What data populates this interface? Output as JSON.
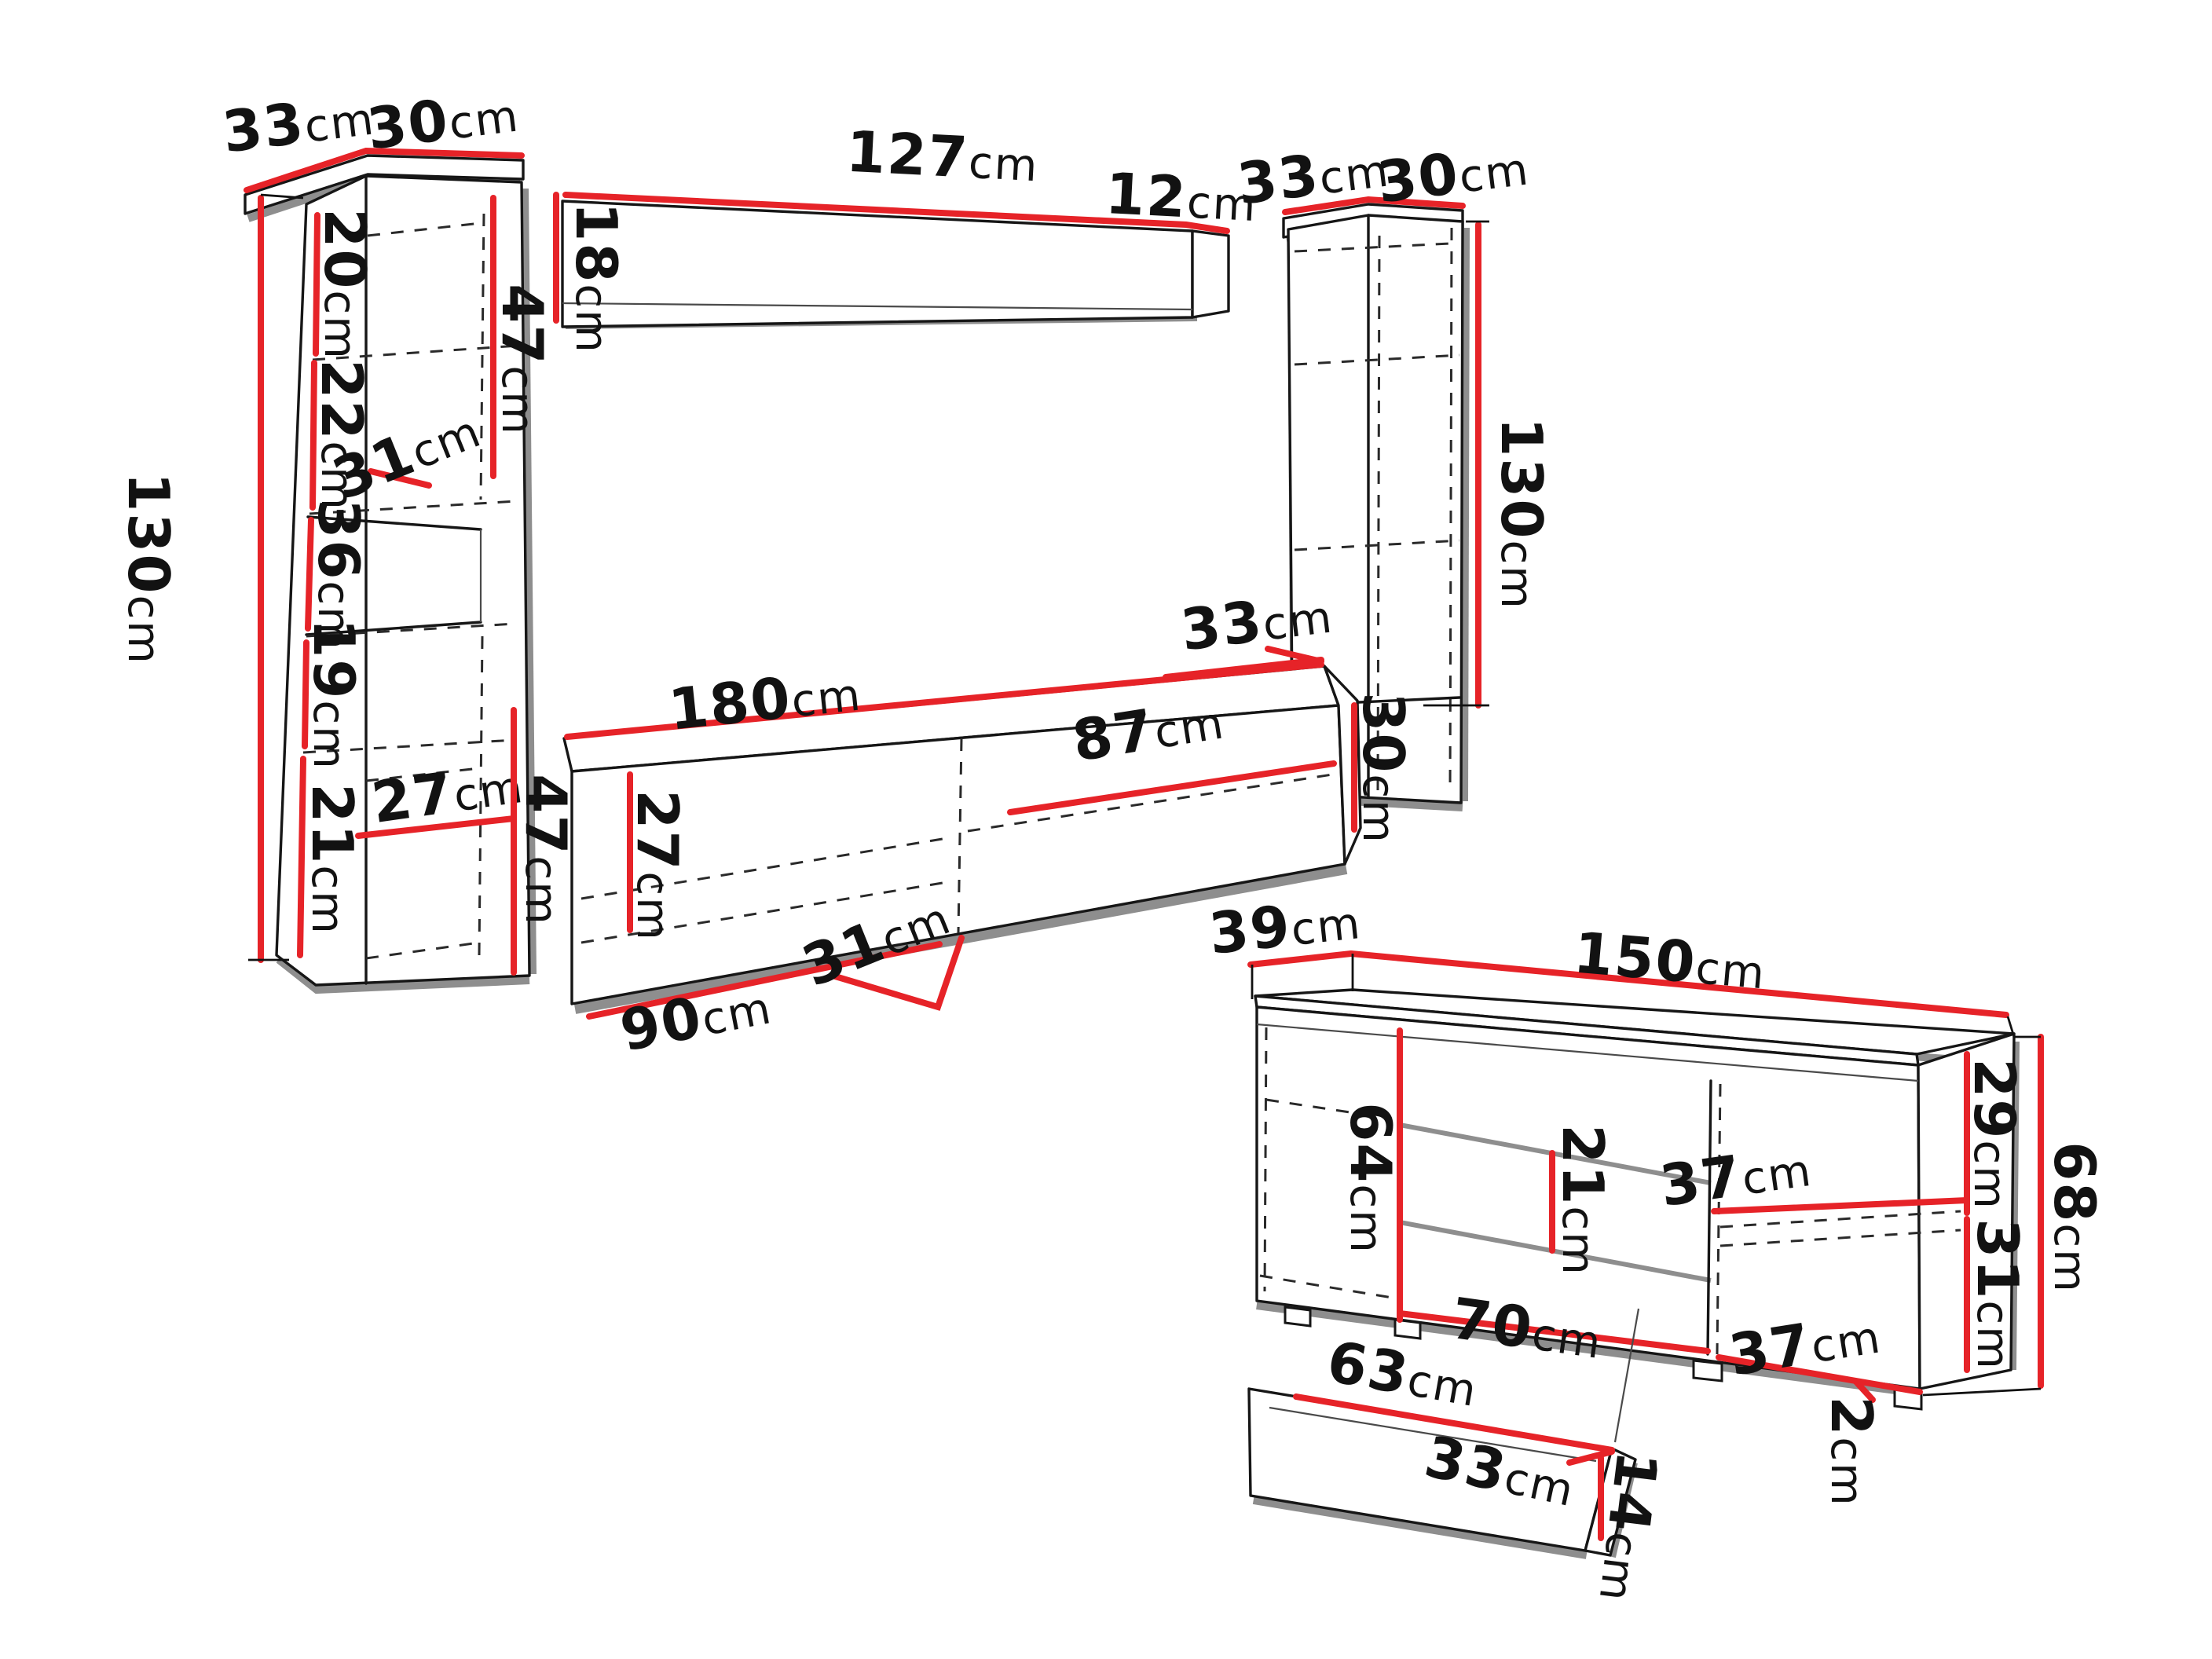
{
  "diagram": {
    "unit": "cm",
    "colors": {
      "dimension_line": "#e62328",
      "outline": "#161616",
      "shadow": "#8e8e8e",
      "background": "#ffffff"
    },
    "dims": {
      "lc_side": {
        "v": "33",
        "u": "cm"
      },
      "lc_front": {
        "v": "30",
        "u": "cm"
      },
      "lc_height": {
        "v": "130",
        "u": "cm"
      },
      "lc_s1": {
        "v": "20",
        "u": "cm"
      },
      "lc_s2": {
        "v": "22",
        "u": "cm"
      },
      "lc_s3": {
        "v": "36",
        "u": "cm"
      },
      "lc_s4": {
        "v": "19",
        "u": "cm"
      },
      "lc_s5": {
        "v": "21",
        "u": "cm"
      },
      "lc_inner_w": {
        "v": "31",
        "u": "cm"
      },
      "lc_inner_d": {
        "v": "27",
        "u": "cm"
      },
      "lc_door": {
        "v": "47",
        "u": "cm"
      },
      "ws_len": {
        "v": "127",
        "u": "cm"
      },
      "ws_depth": {
        "v": "12",
        "u": "cm"
      },
      "ws_height": {
        "v": "18",
        "u": "cm"
      },
      "rc_side": {
        "v": "33",
        "u": "cm"
      },
      "rc_front": {
        "v": "30",
        "u": "cm"
      },
      "rc_height": {
        "v": "130",
        "u": "cm"
      },
      "tv_len": {
        "v": "180",
        "u": "cm"
      },
      "tv_right_w": {
        "v": "87",
        "u": "cm"
      },
      "tv_inner_h": {
        "v": "27",
        "u": "cm"
      },
      "tv_inner_w": {
        "v": "31",
        "u": "cm"
      },
      "tv_left_w": {
        "v": "90",
        "u": "cm"
      },
      "tv_height": {
        "v": "47",
        "u": "cm"
      },
      "tv_end_d": {
        "v": "33",
        "u": "cm"
      },
      "tv_end_h": {
        "v": "30",
        "u": "cm"
      },
      "sb_depth": {
        "v": "39",
        "u": "cm"
      },
      "sb_width": {
        "v": "150",
        "u": "cm"
      },
      "sb_door_h": {
        "v": "64",
        "u": "cm"
      },
      "sb_shelf_gap": {
        "v": "21",
        "u": "cm"
      },
      "sb_shelf_w_top": {
        "v": "37",
        "u": "cm"
      },
      "sb_right_top": {
        "v": "29",
        "u": "cm"
      },
      "sb_right_bot": {
        "v": "31",
        "u": "cm"
      },
      "sb_height": {
        "v": "68",
        "u": "cm"
      },
      "sb_door_w": {
        "v": "70",
        "u": "cm"
      },
      "sb_shelf_w_bot": {
        "v": "37",
        "u": "cm"
      },
      "sb_feet": {
        "v": "2",
        "u": "cm"
      },
      "hs_len": {
        "v": "63",
        "u": "cm"
      },
      "hs_depth": {
        "v": "33",
        "u": "cm"
      },
      "hs_height": {
        "v": "14",
        "u": "cm"
      }
    }
  }
}
